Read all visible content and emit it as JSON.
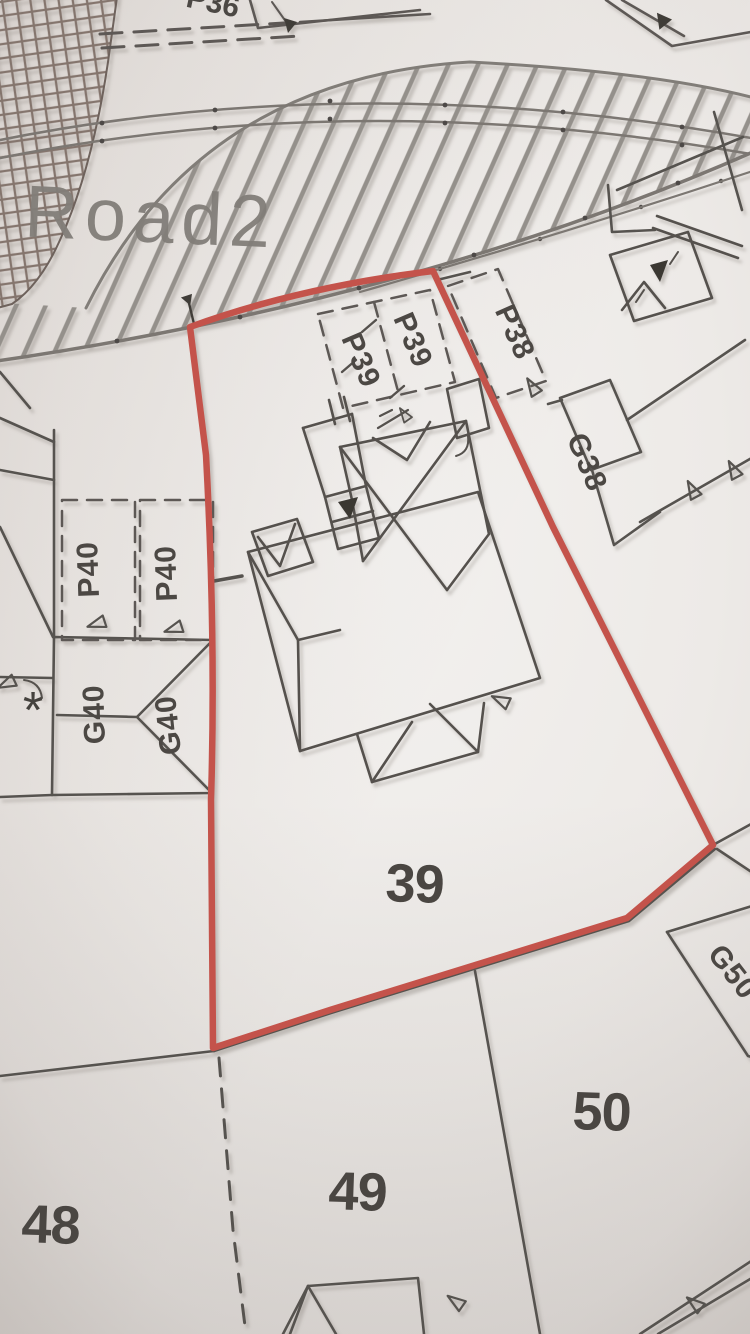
{
  "plan": {
    "road": {
      "name": "Road2"
    },
    "top_partial_label": "P36",
    "plot_numbers": {
      "main": "39",
      "bottom_left": "48",
      "bottom_middle": "49",
      "bottom_right": "50"
    },
    "parking_bays": {
      "p39_a": "P39",
      "p39_b": "P39",
      "p38": "P38",
      "p40_a": "P40",
      "p40_b": "P40"
    },
    "garages": {
      "g40_a": "G40",
      "g40_b": "G40",
      "g38": "G38",
      "g50": "G50"
    },
    "symbols": {
      "asterisk": "*"
    },
    "colors": {
      "plot_outline_red": "#c4534b",
      "boundary_gray": "#57534f",
      "hatch_gray": "#94908b",
      "label_ink": "#4a4642",
      "road_text_gray": "#827e79",
      "paper": "#edeae7"
    }
  }
}
